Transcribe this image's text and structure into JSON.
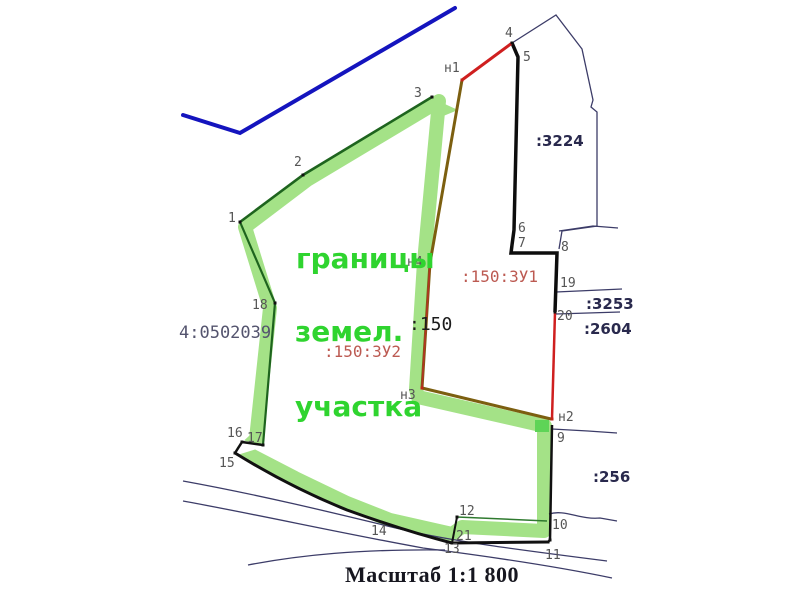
{
  "scale_label": "Масштаб 1:1 800",
  "annotation_lines": [
    {
      "t": "границы",
      "x": 296,
      "y": 268
    },
    {
      "t": "земел.",
      "x": 295,
      "y": 341
    },
    {
      "t": "участка",
      "x": 295,
      "y": 416
    }
  ],
  "parcel_labels": [
    {
      "t": ":3224",
      "x": 536,
      "y": 146,
      "cls": "navy"
    },
    {
      "t": ":3253",
      "x": 586,
      "y": 309,
      "cls": "navy"
    },
    {
      "t": ":2604",
      "x": 584,
      "y": 334,
      "cls": "navy"
    },
    {
      "t": ":256",
      "x": 593,
      "y": 482,
      "cls": "navy"
    },
    {
      "t": ":150:ЗУ1",
      "x": 461,
      "y": 282,
      "cls": "red"
    },
    {
      "t": ":150:ЗУ2",
      "x": 324,
      "y": 357,
      "cls": "red"
    },
    {
      "t": ":150",
      "x": 409,
      "y": 330,
      "cls": "dark"
    },
    {
      "t": "4:0502039",
      "x": 179,
      "y": 338,
      "cls": "gray"
    }
  ],
  "point_labels": [
    {
      "t": "1",
      "x": 228,
      "y": 222
    },
    {
      "t": "2",
      "x": 294,
      "y": 166
    },
    {
      "t": "3",
      "x": 414,
      "y": 97
    },
    {
      "t": "4",
      "x": 505,
      "y": 37
    },
    {
      "t": "5",
      "x": 523,
      "y": 61
    },
    {
      "t": "6",
      "x": 518,
      "y": 232
    },
    {
      "t": "7",
      "x": 518,
      "y": 247
    },
    {
      "t": "8",
      "x": 561,
      "y": 251
    },
    {
      "t": "19",
      "x": 560,
      "y": 287
    },
    {
      "t": "20",
      "x": 557,
      "y": 320
    },
    {
      "t": "9",
      "x": 557,
      "y": 442
    },
    {
      "t": "10",
      "x": 552,
      "y": 529
    },
    {
      "t": "11",
      "x": 545,
      "y": 559
    },
    {
      "t": "12",
      "x": 459,
      "y": 515
    },
    {
      "t": "21",
      "x": 456,
      "y": 540
    },
    {
      "t": "13",
      "x": 444,
      "y": 553
    },
    {
      "t": "14",
      "x": 371,
      "y": 535
    },
    {
      "t": "15",
      "x": 219,
      "y": 467
    },
    {
      "t": "16",
      "x": 227,
      "y": 437
    },
    {
      "t": "17",
      "x": 247,
      "y": 442
    },
    {
      "t": "18",
      "x": 252,
      "y": 309
    },
    {
      "t": "н1",
      "x": 444,
      "y": 72
    },
    {
      "t": "н2",
      "x": 558,
      "y": 421
    },
    {
      "t": "н3",
      "x": 400,
      "y": 399
    },
    {
      "t": "н4",
      "x": 407,
      "y": 266
    }
  ],
  "colors": {
    "band": "#a4e287",
    "band_bright": "#5ed457",
    "green_line": "#1e641e",
    "black_line": "#111111",
    "navy_line": "#3c3c68",
    "navy_bold": "#29294d",
    "blue_road": "#1414be",
    "red_line": "#cf1f1f",
    "olive_line": "#7c5f10",
    "muted_red": "#bc5a52",
    "gray_label": "#555555",
    "gray_navy": "#54546e",
    "green_text": "#2fd42f",
    "scale_color": "#16161f"
  }
}
